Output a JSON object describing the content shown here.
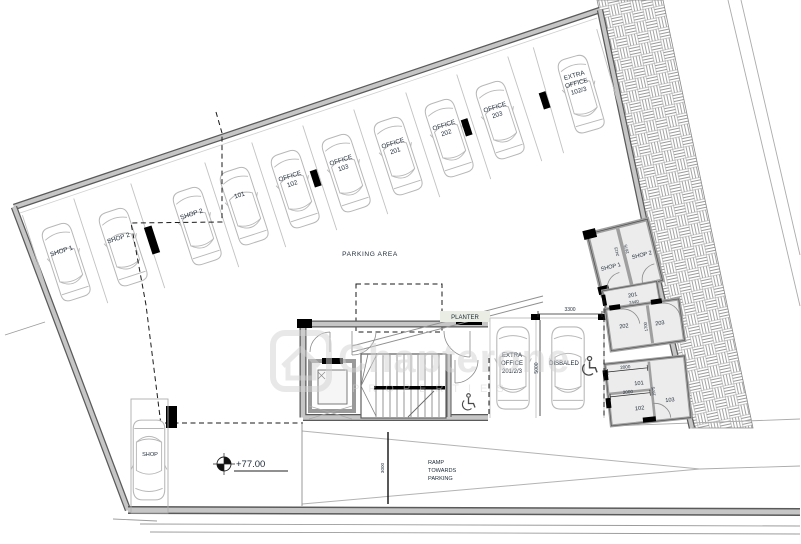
{
  "watermark": {
    "brand": "Chapterone",
    "subtitle": "PROPERTIES"
  },
  "labels": {
    "parking_area": "PARKING AREA",
    "planter": "PLANTER",
    "ramp_lines": [
      "RAMP",
      "TOWARDS",
      "PARKING"
    ],
    "level_marker": "+77.00"
  },
  "top_row_stalls": [
    {
      "lines": [
        "SHOP 1"
      ]
    },
    {
      "lines": [
        "SHOP 2"
      ]
    },
    {
      "lines": [
        "SHOP 2"
      ]
    },
    {
      "lines": [
        "101"
      ]
    },
    {
      "lines": [
        "OFFICE",
        "102"
      ]
    },
    {
      "lines": [
        "OFFICE",
        "103"
      ]
    },
    {
      "lines": [
        "OFFICE",
        "201"
      ]
    },
    {
      "lines": [
        "OFFICE",
        "202"
      ]
    },
    {
      "lines": [
        "OFFICE",
        "203"
      ]
    },
    {
      "lines": [
        "EXTRA",
        "OFFICE",
        "102/3"
      ]
    }
  ],
  "island_stalls": {
    "extra_office": {
      "lines": [
        "EXTRA",
        "OFFICE",
        "201/2/3"
      ]
    },
    "disabled": {
      "label": "DISBALED"
    },
    "shop_bottom": {
      "label": "SHOP"
    }
  },
  "rooms": {
    "shop1": "SHOP 1",
    "shop2": "SHOP 2",
    "r201": "201",
    "r202": "202",
    "r203": "203",
    "r101": "101",
    "r102": "102",
    "r103": "103"
  },
  "dimensions": {
    "d3300": "3300",
    "d5000": "5000",
    "d2440": "2440",
    "d1700": "1700",
    "d2000a": "2000",
    "d2000b": "2000",
    "d1975": "1975",
    "d3000": "3000",
    "d2415": "2415",
    "d2675": "2675"
  },
  "colors": {
    "text": "#1d2a38",
    "boundary_wall_edge": "#5a5a5a",
    "boundary_wall_fill": "#c6c6c6",
    "stall_line": "#c2c2c2",
    "car_outline": "#b7b7b7",
    "hatch": "#9a9a9a",
    "watermark": "#d2d2d2",
    "background": "#ffffff"
  }
}
